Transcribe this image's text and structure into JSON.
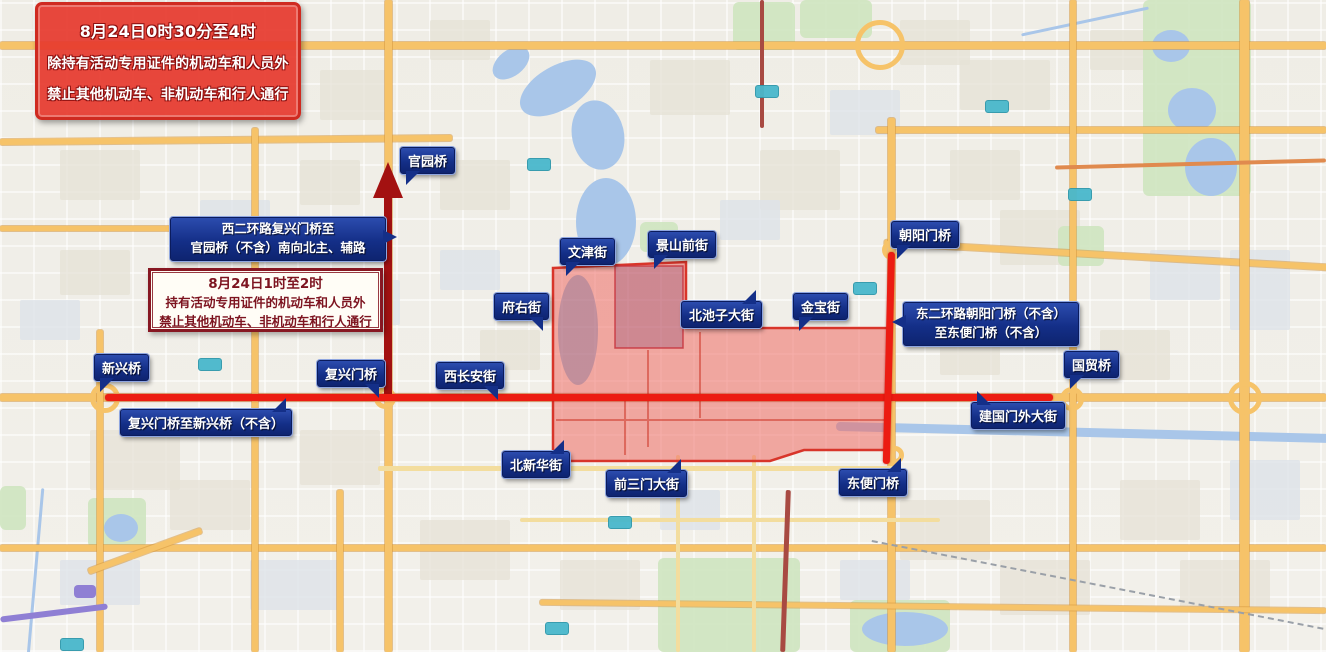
{
  "banner": {
    "lines": [
      "8月24日0时30分至4时",
      "除持有活动专用证件的机动车和人员外",
      "禁止其他机动车、非机动车和行人通行"
    ]
  },
  "notice": {
    "lines": [
      "8月24日1时至2时",
      "持有活动专用证件的机动车和人员外",
      "禁止其他机动车、非机动车和行人通行"
    ]
  },
  "labels": {
    "xierhuan_route": [
      "西二环路复兴门桥至",
      "官园桥（不含）南向北主、辅路"
    ],
    "dongerhuan_route": [
      "东二环路朝阳门桥（不含）",
      "至东便门桥（不含）"
    ],
    "guanyuan_bridge": "官园桥",
    "wenjin_street": "文津街",
    "jingshanqian_street": "景山前街",
    "chaoyangmen_bridge": "朝阳门桥",
    "fuyou_street": "府右街",
    "beichizi_street": "北池子大街",
    "jinbao_street": "金宝街",
    "xinxing_bridge": "新兴桥",
    "fuxingmen_bridge": "复兴门桥",
    "xichangan_street": "西长安街",
    "guomao_bridge": "国贸桥",
    "jianguomenwai_street": "建国门外大街",
    "fuxingmen_to_xinxing": "复兴门桥至新兴桥（不含）",
    "beixinhua_street": "北新华街",
    "qiansanmen_street": "前三门大街",
    "dongbianmen_bridge": "东便门桥"
  },
  "colors": {
    "restricted_zone_fill": "#ef6a62",
    "restricted_zone_outline": "#d8352a",
    "closed_road_red": "#ec1c12",
    "closed_road_dark_red": "#a31111",
    "label_blue": "#142f88",
    "banner_red": "#e63a2e",
    "notice_border_red": "#871722",
    "major_road_orange": "#f6c369",
    "park_green": "#cfe5c0",
    "water_blue": "#a9c6e9"
  }
}
